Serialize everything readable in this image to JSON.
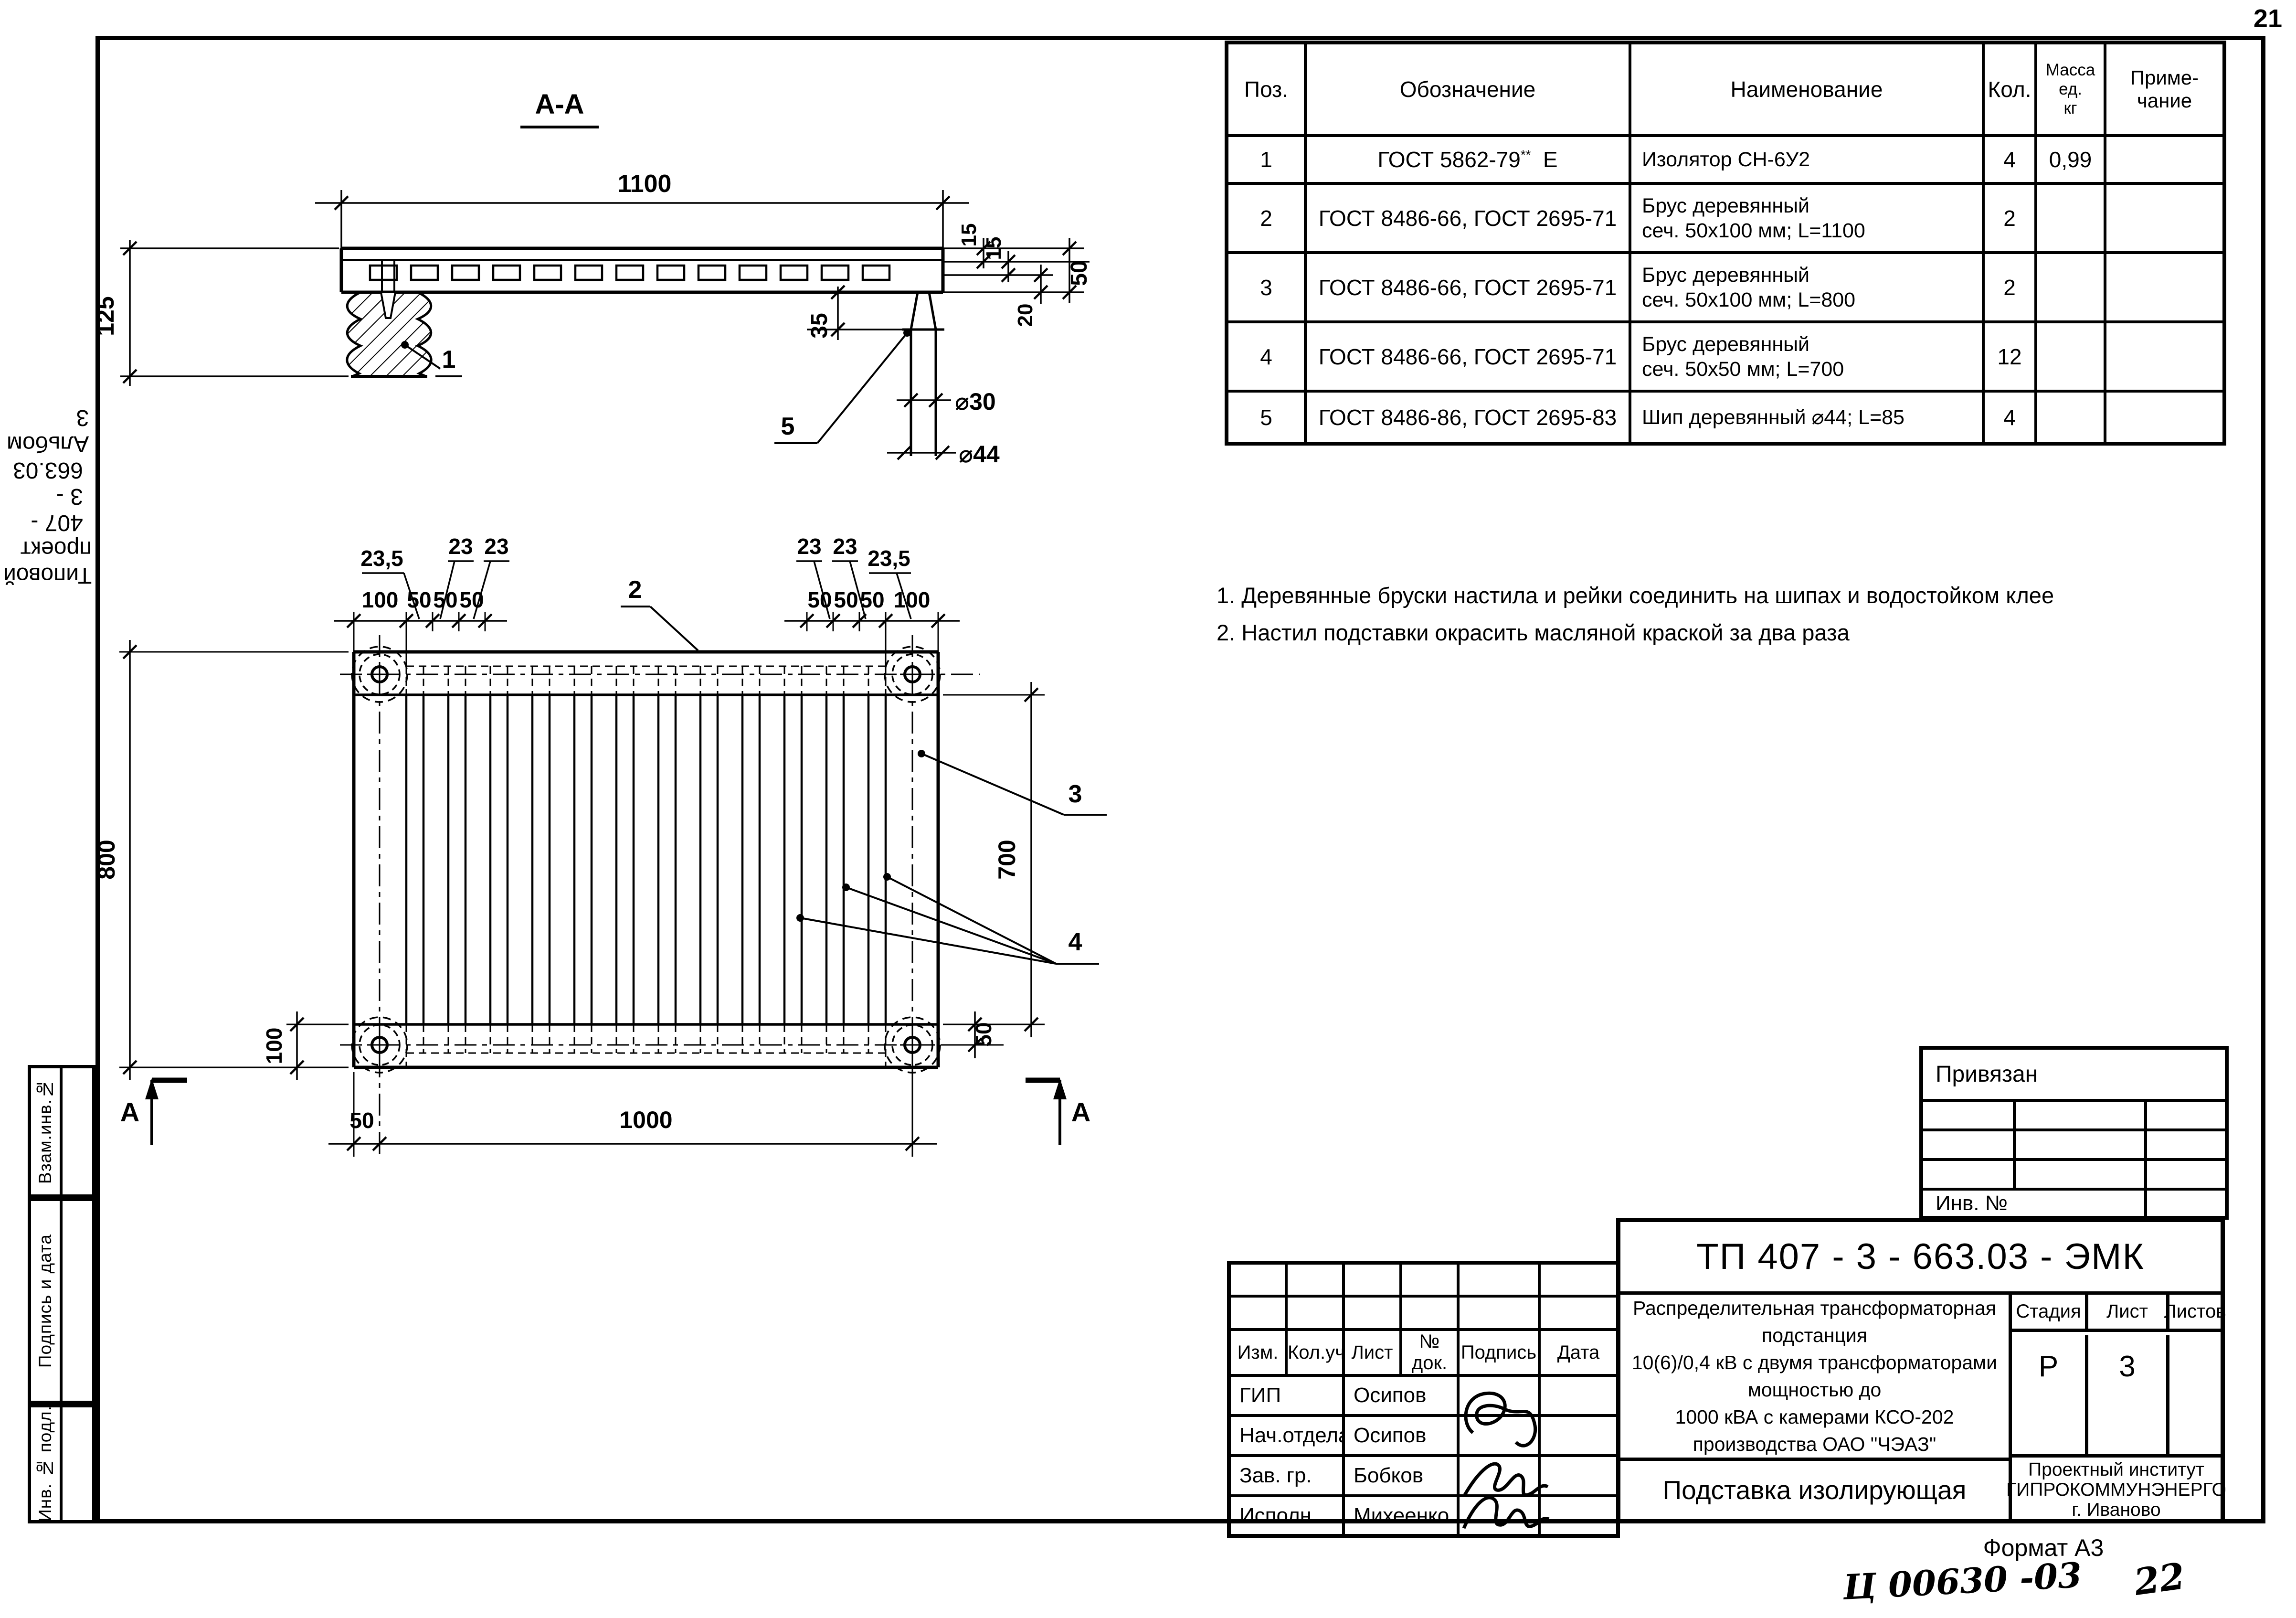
{
  "page": {
    "number": "21",
    "format_label": "Формат А3",
    "handwritten_code": "Ц 00630 -03",
    "handwritten_page": "22"
  },
  "side_labels": {
    "project": "Типовой проект",
    "project_code": "407 - 3 - 663.03",
    "album": "Альбом 3",
    "boxes": [
      "Взам.инв.№",
      "Подпись и дата",
      "Инв. № подл."
    ]
  },
  "parts_table": {
    "headers": {
      "pos": "Поз.",
      "designation": "Обозначение",
      "name": "Наименование",
      "qty": "Кол.",
      "mass1": "Масса",
      "mass2": "ед.",
      "mass3": "кг",
      "note1": "Приме-",
      "note2": "чание"
    },
    "rows": [
      {
        "pos": "1",
        "designation": "ГОСТ 5862-79",
        "designation_sup": "**",
        "designation_suffix": "Е",
        "name1": "Изолятор СН-6У2",
        "name2": "",
        "qty": "4",
        "mass": "0,99",
        "note": ""
      },
      {
        "pos": "2",
        "designation": "ГОСТ 8486-66, ГОСТ 2695-71",
        "name1": "Брус деревянный",
        "name2": "сеч. 50х100 мм; L=1100",
        "qty": "2",
        "mass": "",
        "note": ""
      },
      {
        "pos": "3",
        "designation": "ГОСТ 8486-66, ГОСТ 2695-71",
        "name1": "Брус деревянный",
        "name2": "сеч. 50х100 мм; L=800",
        "qty": "2",
        "mass": "",
        "note": ""
      },
      {
        "pos": "4",
        "designation": "ГОСТ 8486-66, ГОСТ 2695-71",
        "name1": "Брус деревянный",
        "name2": "сеч. 50х50 мм; L=700",
        "qty": "12",
        "mass": "",
        "note": ""
      },
      {
        "pos": "5",
        "designation": "ГОСТ 8486-86, ГОСТ 2695-83",
        "name1": "Шип деревянный ⌀44; L=85",
        "name2": "",
        "qty": "4",
        "mass": "",
        "note": ""
      }
    ]
  },
  "notes": [
    "1. Деревянные бруски настила и рейки соединить на шипах и водостойком клее",
    "2. Настил подставки окрасить масляной краской за два раза"
  ],
  "binding_stamp": {
    "title": "Привязан",
    "inv_label": "Инв. №"
  },
  "title_block": {
    "doc_code": "ТП 407 - 3 - 663.03 - ЭМК",
    "header_cells": [
      "Изм.",
      "Кол.уч",
      "Лист",
      "№ док.",
      "Подпись",
      "Дата"
    ],
    "signature_rows": [
      {
        "role": "ГИП",
        "name": "Осипов"
      },
      {
        "role": "Нач.отдела",
        "name": "Осипов"
      },
      {
        "role": "Зав. гр.",
        "name": "Бобков"
      },
      {
        "role": "Исполн.",
        "name": "Михеенко"
      }
    ],
    "project_description1": "Распределительная трансформаторная подстанция",
    "project_description2": "10(6)/0,4 кВ с двумя трансформаторами мощностью до",
    "project_description3": "1000 кВА с камерами КСО-202 производства ОАО \"ЧЭАЗ\"",
    "stage_label": "Стадия",
    "stage_value": "Р",
    "sheet_label": "Лист",
    "sheet_value": "3",
    "sheets_label": "Листов",
    "sheets_value": "",
    "drawing_title": "Подставка изолирующая",
    "org1": "Проектный институт",
    "org2": "ГИПРОКОММУНЭНЕРГО",
    "org3": "г. Иваново"
  },
  "drawing": {
    "section_label": "А-А",
    "dims": {
      "length": "1100",
      "height": "125",
      "t15a": "15",
      "t15b": "15",
      "t50": "50",
      "t20": "20",
      "t35": "35",
      "d30": "⌀30",
      "d44": "⌀44",
      "plan_height": "800",
      "rail_width": "100",
      "batten_len": "700",
      "off_right": "50",
      "off_bottom": "50",
      "width": "1000",
      "left_chain": [
        "100",
        "50",
        "50",
        "50"
      ],
      "left_gaps": [
        "23,5",
        "23",
        "23"
      ],
      "right_chain": [
        "50",
        "50",
        "50",
        "100"
      ],
      "right_gaps": [
        "23",
        "23",
        "23,5"
      ]
    },
    "callouts": {
      "c1": "1",
      "c2": "2",
      "c3": "3",
      "c4": "4",
      "c5": "5"
    },
    "section_mark": "А"
  }
}
